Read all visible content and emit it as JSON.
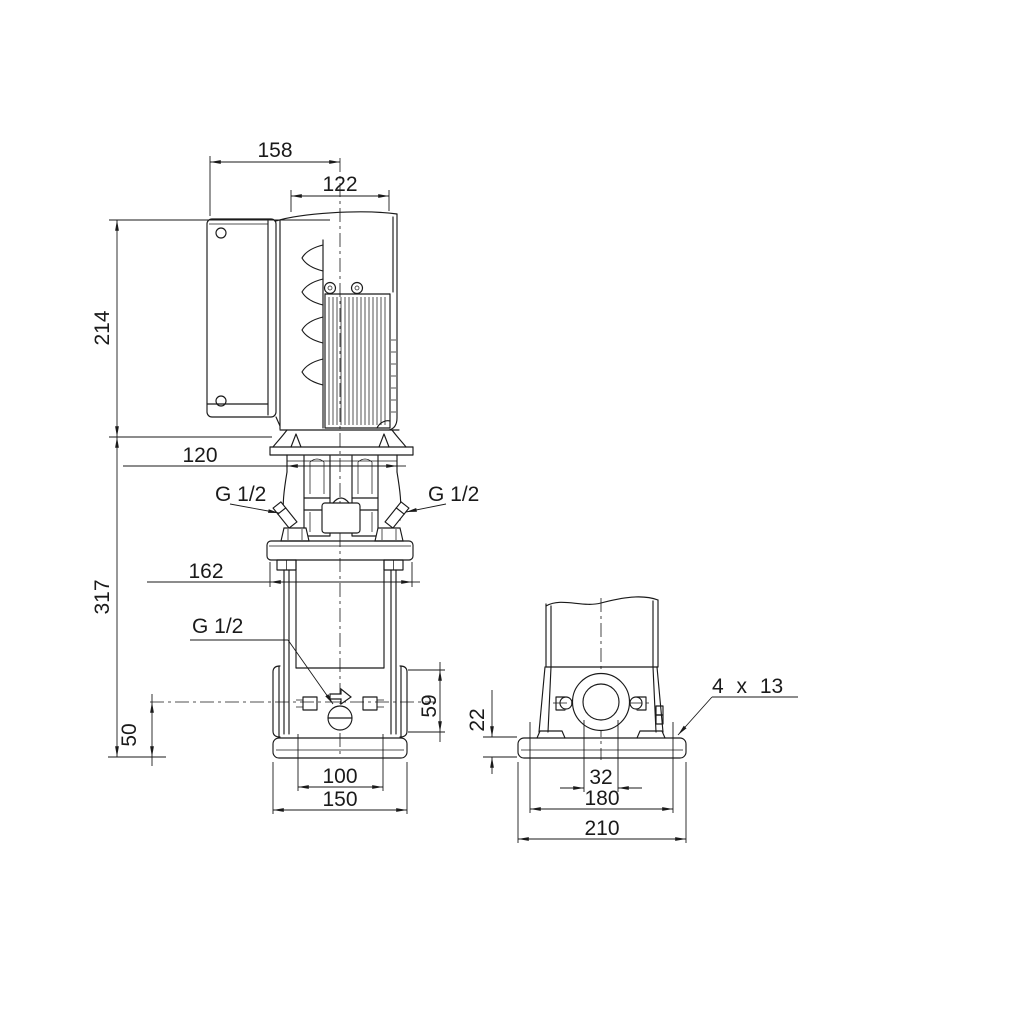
{
  "colors": {
    "background": "#ffffff",
    "line": "#1a1a1a"
  },
  "dims": {
    "d158": "158",
    "d122": "122",
    "d214": "214",
    "d120": "120",
    "d317": "317",
    "d162": "162",
    "d50": "50",
    "d100": "100",
    "d150": "150",
    "d59": "59",
    "d22": "22",
    "d32": "32",
    "d180": "180",
    "d210": "210"
  },
  "ports": {
    "head_left": "G 1/2",
    "head_right": "G 1/2",
    "drain": "G 1/2"
  },
  "callouts": {
    "base_holes": "4 x 13"
  }
}
